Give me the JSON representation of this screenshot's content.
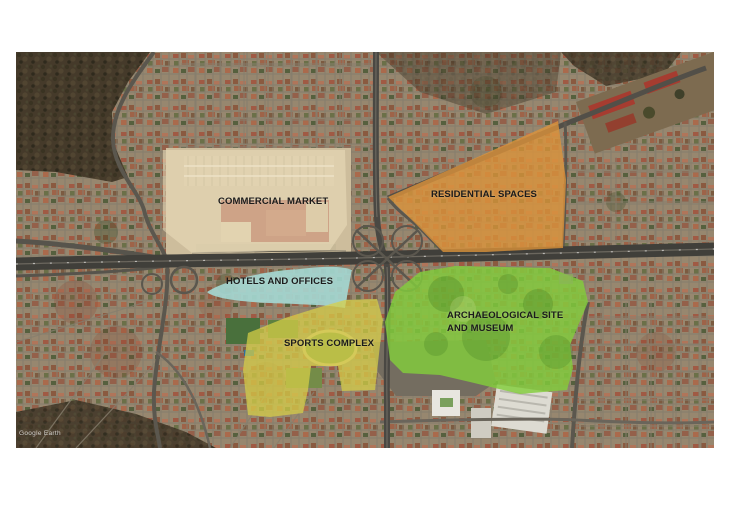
{
  "map": {
    "watermark": "Google Earth"
  },
  "zones": [
    {
      "label": "COMMERCIAL MARKET",
      "color": "#ECDEBC",
      "color_rgba": "rgba(236,222,188,0.55)"
    },
    {
      "label": "RESIDENTIAL SPACES",
      "color": "#DE943A",
      "color_rgba": "rgba(222,148,58,0.78)"
    },
    {
      "label": "HOTELS AND OFFICES",
      "color": "#A5DBD6",
      "color_rgba": "rgba(165,219,214,0.88)"
    },
    {
      "label": "SPORTS COMPLEX",
      "color": "#D8D046",
      "color_rgba": "rgba(216,208,70,0.72)"
    },
    {
      "label": "ARCHAEOLOGICAL SITE AND MUSEUM",
      "label_line1": "ARCHAEOLOGICAL SITE",
      "label_line2": "AND MUSEUM",
      "color": "#82CD3C",
      "color_rgba": "rgba(130,205,60,0.82)"
    }
  ]
}
